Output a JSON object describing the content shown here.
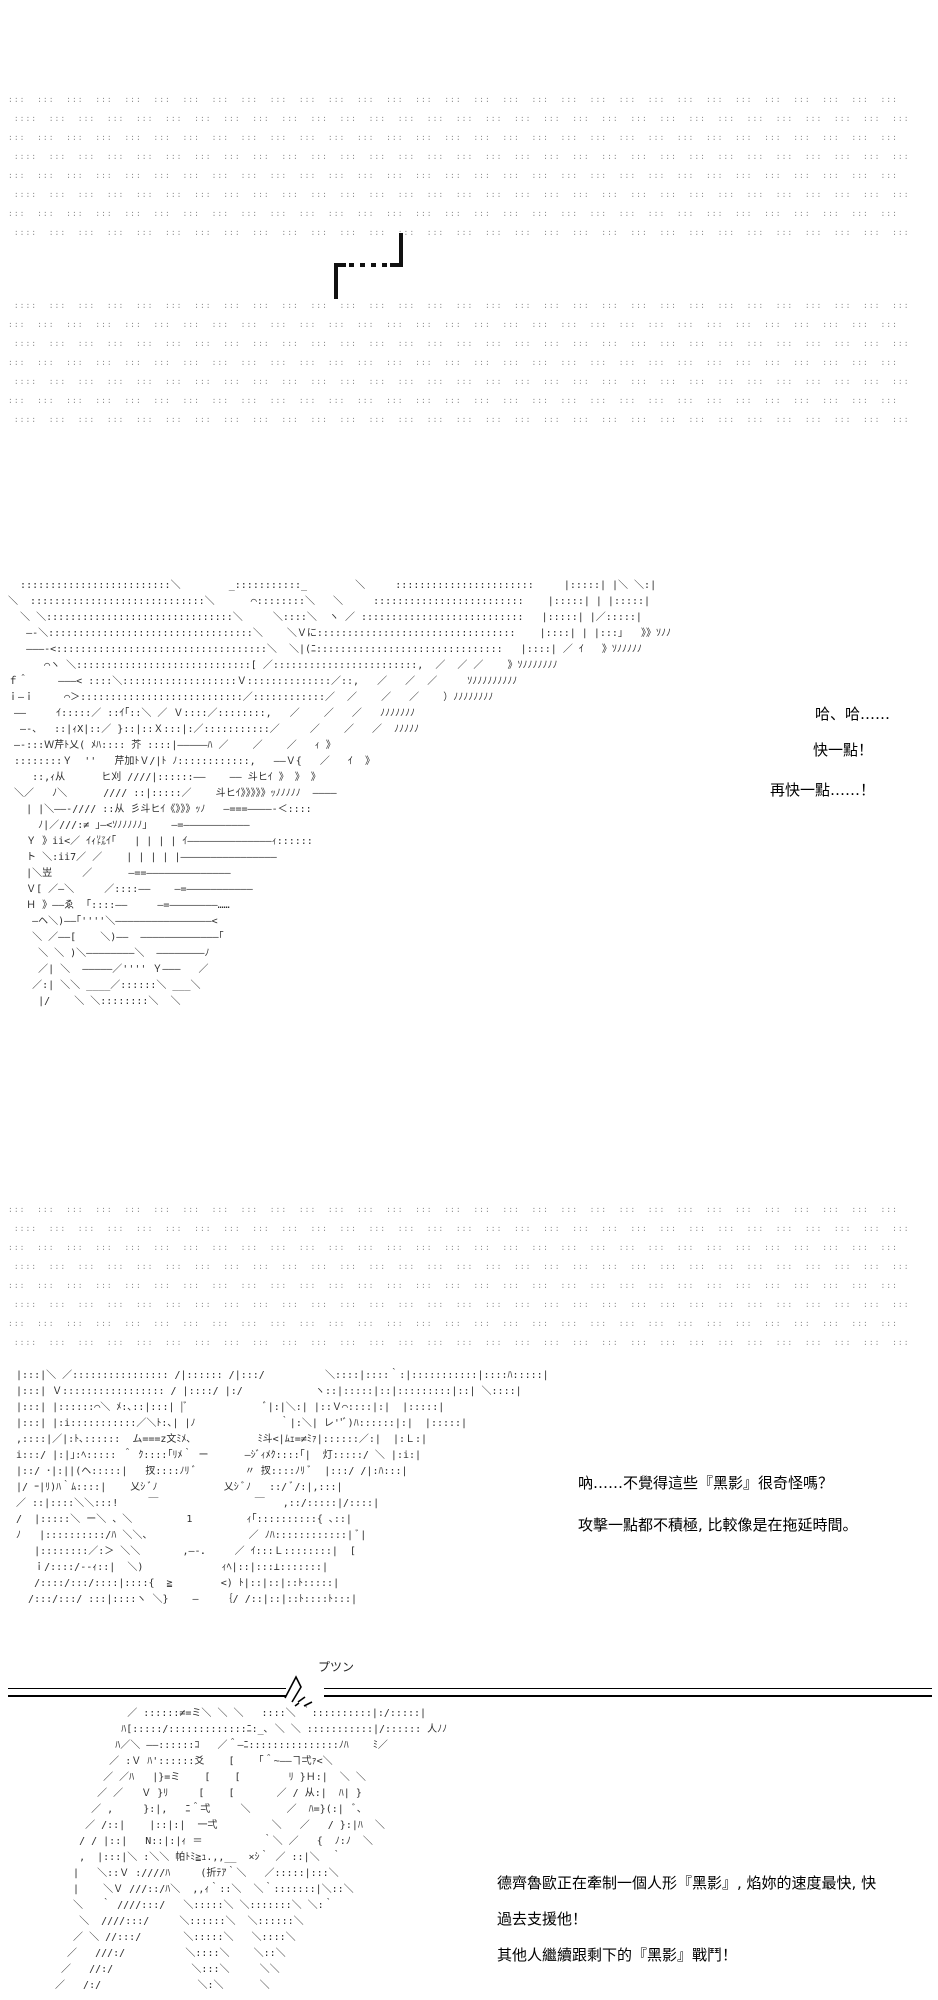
{
  "colors": {
    "ink": "#2b2b2b",
    "dots": "#8f8f8f",
    "text": "#000000"
  },
  "dialogue": {
    "ha": "哈、哈……",
    "faster": "快一點！",
    "even_faster": "再快一點……！",
    "strange1": "吶……不覺得這些『黑影』很奇怪嗎？",
    "strange2": "攻擊一點都不積極, 比較像是在拖延時間。",
    "order1": "德齊魯歐正在牽制一個人形『黑影』, 焰妳的速度最快, 快",
    "order2": "過去支援他！",
    "order3": "其他人繼續跟剩下的『黑影』戰鬥！",
    "snap_sfx": "プツン"
  },
  "dots": {
    "block1": {
      "rows": 8,
      "repeat": 31,
      "unit": ":::  ",
      "even_prefix": "",
      "odd_prefix": " :"
    },
    "block2": {
      "rows": 7,
      "repeat": 31,
      "unit": ":::  ",
      "even_prefix": " :",
      "odd_prefix": ""
    },
    "block3": {
      "rows": 8,
      "repeat": 31,
      "unit": ":::  ",
      "even_prefix": "",
      "odd_prefix": " :"
    }
  },
  "aa": {
    "main_scene": {
      "lines": [
        "   :::::::::::::::::::::::::＼        _:::::::::::_        ＼     :::::::::::::::::::::::     |:::::| |＼ ＼:|",
        " ＼  :::::::::::::::::::::::::::::＼      ⌒::::::::＼   ＼     :::::::::::::::::::::::::    |:::::| | |:::::|",
        "   ＼ ＼:::::::::::::::::::::::::::::::＼     ＼::::＼  ヽ ／ :::::::::::::::::::::::::::   |:::::| |／:::::|",
        "    ―-＼::::::::::::::::::::::::::::::::::＼    ＼Ｖに:::::::::::::::::::::::::::::::::    |::::| | |:::｣   》》ｿﾉﾉ",
        "    ―――-<:::::::::::::::::::::::::::::::::::＼  ＼|(ﾆ:::::::::::::::::::::::::::::::   |::::| ／ ｲ   》ｿﾉﾉﾉﾉﾉ",
        "       ⌒ヽ ＼:::::::::::::::::::::::::::::[ ／::::::::::::::::::::::::,  ／  ／ ／    》ｿﾉﾉﾉﾉﾉﾉﾉ",
        " ｆ＾     ―――< ::::＼:::::::::::::::::::Ｖ::::::::::::::／::,   ／   ／  ／     ｿﾉﾉﾉﾉﾉﾉﾉﾉﾉ",
        " ｉ―ｉ     ⌒＞:::::::::::::::::::::::::::／::::::::::::／  ／    ／   ／    ）ﾉﾉﾉﾉﾉﾉﾉﾉ",
        "  ――     ｲ:::::／ ::ｲ｢::＼ ／ Ｖ::::／::::::::,   ／    ／   ／   ﾉﾉﾉﾉﾉﾉﾉ",
        "   ―-、  ::|ｨX|::／ }::|::Ｘ:::|:／:::::::::::／     ／    ／   ／  ﾉﾉﾉﾉﾉ",
        "  ―-:::Ｗ芹ﾄ乂( ﾒﾊ:::: 芥 ::::|―――――ﾊ ／    ／    ／   ｨ 》",
        "  ::::::::Ｙ  ''   芹加ﾄＶ/|ﾄ ﾉ::::::::::::,   ――Ｖ{   ／   ｲ  》",
        "     ::,ｨ从      ヒ刈 ////|::::::――    ―― 斗ヒｲ 》 》 》",
        "  ＼／   ﾉ＼      //// ::|:::::／    斗ヒｲ》》》》》ｯﾉﾉﾉﾉﾉ  ――――",
        "    | |＼――-//// ::从 彡斗ヒｲ《》》》ｯﾉ   ―===――――-＜::::",
        "      ﾉ|／///:≠ ｣―<ｿﾉﾉﾉﾉﾉ｣    ―=―――――――――――",
        "    Ｙ 》ii<／ ｲｨ㍑ｲ｢   | | | | ｲ――――――――――――――ｨ::::::",
        "    ト ＼:ii7／ ／    | | | | |――――――――――――――――",
        "    |＼岦     ／      ―==――――――――――――――",
        "    Ｖ[ ／―＼     ／::::――    ―=―――――――――――",
        "    Ｈ 》――ゑ  ｢::::――     ―=――――――――……",
        "     ―ヘ＼)――｢''''＼――――――――――――――――<",
        "     ＼ ／――[    ＼)――  ―――――――――――――｢",
        "      ＼ ＼ )＼――――――――＼  ――――――――ﾉ",
        "      ／| ＼  ―――――／'''' Ｙ―――   ／",
        "     ／:| ＼＼ ____／::::::＼ ___＼",
        "      |/    ＼ ＼::::::::＼  ＼"
      ]
    },
    "two_faces": {
      "lines": [
        " |:::|＼ ／:::::::::::::::: /|:::::: /|:::/          ＼::::|::::｀:|:::::::::::|::::ﾊ:::::|",
        " |:::| Ｖ::::::::::::::::: / |::::/ |:/            ヽ::|:::::|::|:::::::::|::| ＼::::|",
        " |:::| |::::::⌒＼ ﾒ:､::|:::| |ﾞ             ﾞ|:|＼:| |::Ｖ⌒::::|:|  |:::::|",
        " |:::| |:i:::::::::::／＼ﾄ:､| |ﾉ              ｀|:＼| レ''ﾞ)ﾊ::::::|:|  |:::::|",
        " ,::::|／|:ﾄ､::::::  ム===z文ﾐﾒ､           ﾐ斗<|ﾑｪ=≠ﾐｧ|::::::／:|  |:Ｌ:|",
        " i:::/ |:|｣:ﾍ::::: ＾ ｸ::::｢ﾘﾒ｀ ー      ―ｼﾞｨﾒｸ::::｢|  灯:::::/ ＼ |:i:|",
        " |::/ ･|:||(ヘ:::::|   扠::::ﾉﾘ ﾞ        〃 扠::::ﾉﾘ ﾞ  |:::/ /|:ﾊ:::|",
        " |/ ｰ|ﾘ)ﾊ｀ﾑ::::|    乂ｼ ﾞﾉ           乂ｼ ﾞﾉ   ::/ ﾞ/:|,:::|",
        " ／ ::|::::＼＼:::!     ￣                ￣   ,::/:::::|/::::|",
        " /  |:::::＼ ー＼ 、＼         1         ｨ｢::::::::::{ ､::|",
        " ﾉ   |::::::::::/ﾊ ＼＼、                ／ ﾉﾊ::::::::::::| ﾞ|",
        "    |::::::::／:＞ ＼＼       ,―-．    ／ ｲ:::Ｌ::::::::|  [",
        "    ｉ/::::/--ｨ::|  ＼)             ｨﾍ|::|:::⊥:::::::|",
        "    /::::/:::/::::|::::{  ≧        <) ﾄ|::|::|::ﾄ:::::|",
        "   /:::/:::/ :::|::::ヽ ＼}    ―    ｛/ /::|::|::ﾄ::::ﾄ:::|"
      ]
    },
    "bottom_face": {
      "lines": [
        "            ／ ::::::≠=ミ＼ ＼ ＼   ::::＼ ｀::::::::::|:/:::::|",
        "           ﾊ[:::::/:::::::::::::ﾆ:_､ ＼ ＼ :::::::::::|/:::::: 人ﾉﾉ",
        "          ﾊ／＼ ――::::::ｺ   ／＾―ﾆ:::::::::::::::ﾉﾊ    ﾐ／",
        "         ／ :Ｖ ﾊ'::::::爻    [    ｢＾~――ヿ弌ｧ<＼",
        "        ／ ／ﾊ   |}=ミ    [    [        ﾘ }Ｈ:|  ＼ ＼",
        "       ／ ／   Ｖ }ﾘ     [    [       ／ / 从:|  ﾊ| }",
        "      ／ ,     }:|,   ﾆ＾弌     ＼      ／  ﾊ=}(:|  ﾞ､",
        "     ／ /::|    |::|:|  一弌         ＼   ／   / }:|ﾊ  ＼",
        "    / / |::|   N::|:|ｨ ＝          ｀＼ ／   {  ﾉ:ﾉ  ＼",
        "    ,  |:::|＼ :＼＼ 帕ﾄﾐ≧ｭ.,,__  ×ｼ｀ ／ ::|＼  ｀",
        "   |   ＼::Ｖ :////ﾊ     (折ﾃｱ｀＼   ／:::::|:::＼",
        "   |    ＼Ｖ ///::/ﾊ＼  ,,ｨ｀::＼  ＼｀:::::::|＼::＼",
        "   ＼   ｀ ////:::/   ＼:::::＼ ＼:::::::＼ ＼:｀",
        "    ＼  ////:::/     ＼::::::＼  ＼::::::＼",
        "   ／ ＼ //:::/       ＼:::::＼   ＼::::＼",
        "  ／   ///:/          ＼::::＼    ＼::＼",
        " ／   //:/             ＼:::＼     ＼＼",
        "／   /:/                ＼:＼      ＼"
      ]
    }
  }
}
